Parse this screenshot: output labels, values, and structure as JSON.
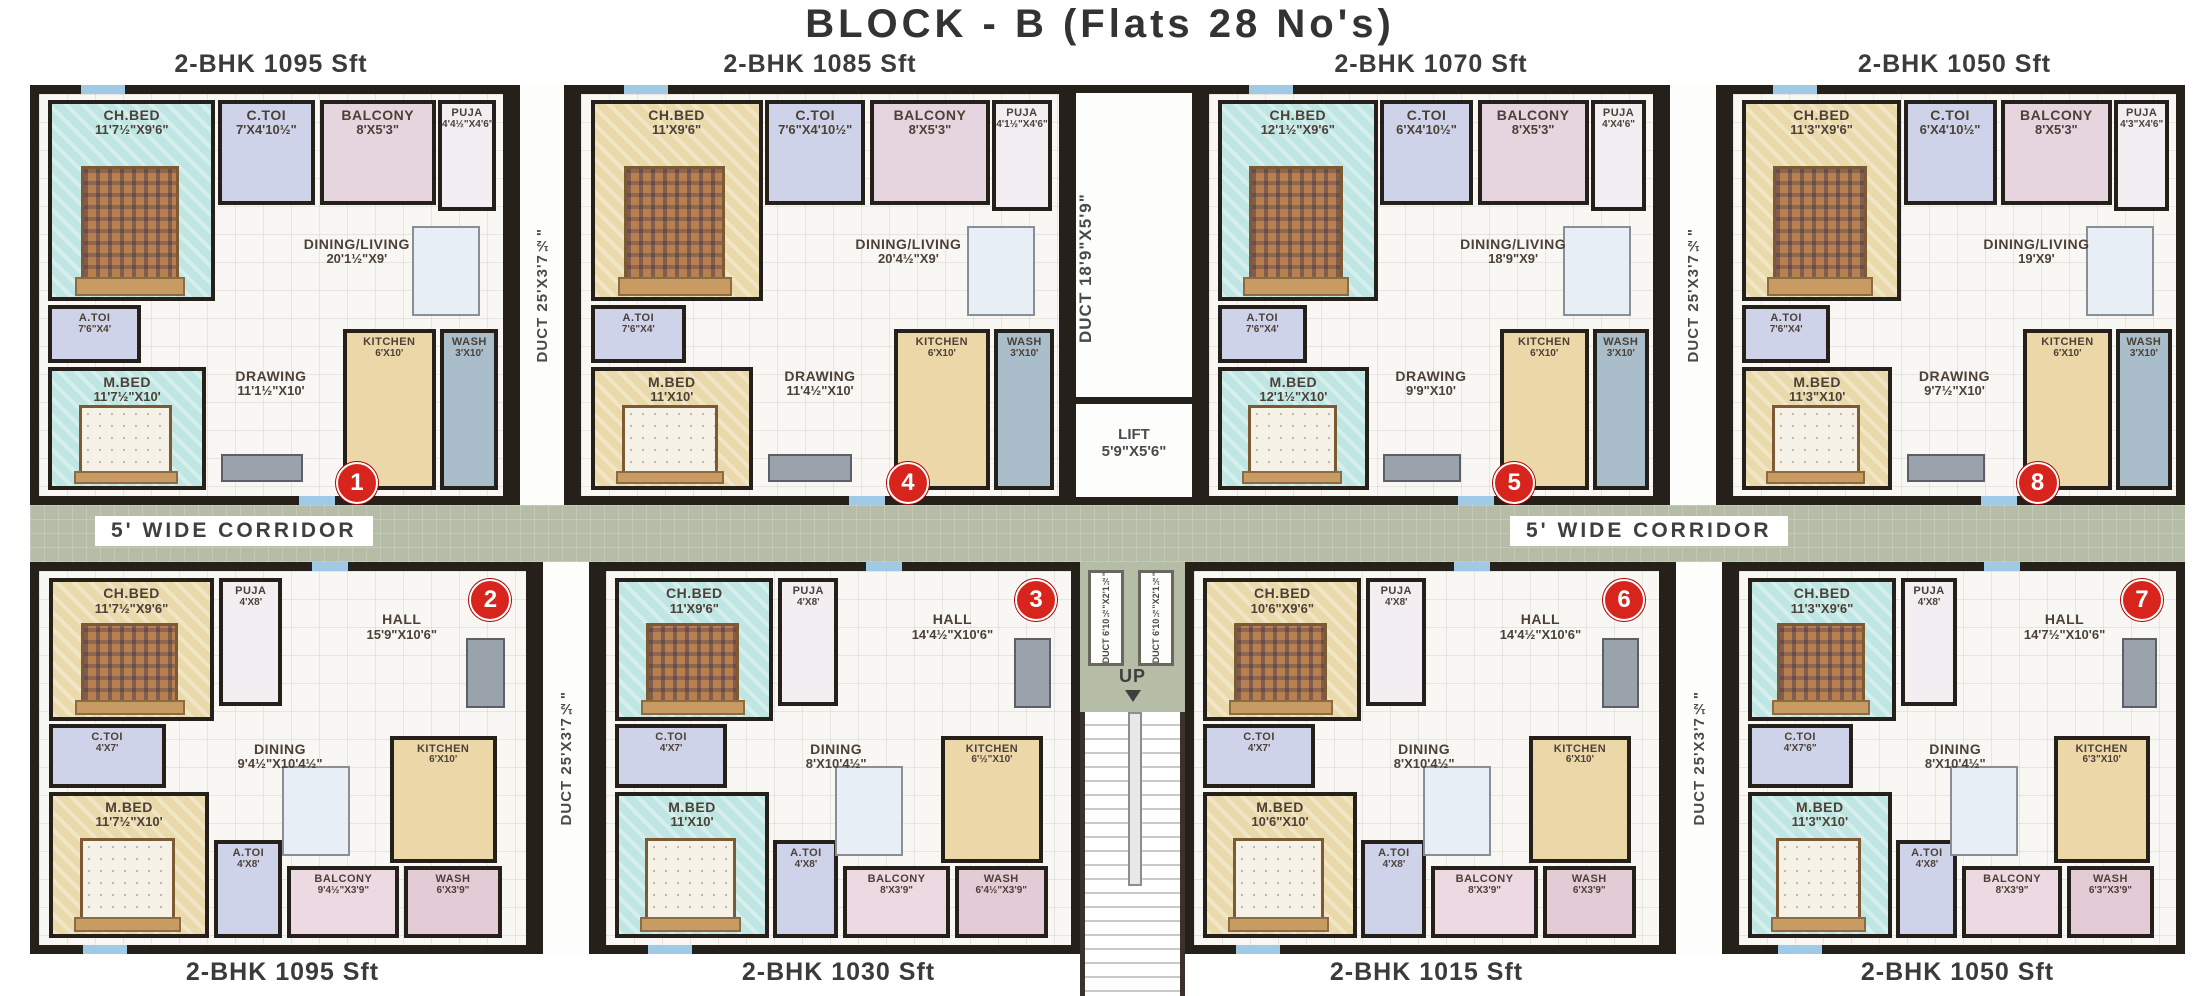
{
  "title": "BLOCK - B (Flats 28 No's)",
  "corridor_label": "5' WIDE CORRIDOR",
  "stairs": {
    "up_label": "UP"
  },
  "lift": {
    "name": "LIFT",
    "dim": "5'9\"X5'6\""
  },
  "ducts": {
    "side": {
      "name": "DUCT",
      "dim": "25'X3'7½\""
    },
    "center": {
      "name": "DUCT",
      "dim": "18'9\"X5'9\""
    },
    "small": {
      "name": "DUCT",
      "dim": "6'10½\"X2'1½\""
    }
  },
  "flats": [
    {
      "id": 1,
      "type_label": "2-BHK 1095 Sft",
      "badge": "1",
      "rooms": {
        "ch_bed": {
          "name": "CH.BED",
          "dim": "11'7½\"X9'6\""
        },
        "c_toi": {
          "name": "C.TOI",
          "dim": "7'X4'10½\""
        },
        "balcony": {
          "name": "BALCONY",
          "dim": "8'X5'3\""
        },
        "puja": {
          "name": "PUJA",
          "dim": "4'4½\"X4'6\""
        },
        "dining": {
          "name": "DINING/LIVING",
          "dim": "20'1½\"X9'"
        },
        "a_toi": {
          "name": "A.TOI",
          "dim": "7'6\"X4'"
        },
        "m_bed": {
          "name": "M.BED",
          "dim": "11'7½\"X10'"
        },
        "drawing": {
          "name": "DRAWING",
          "dim": "11'1½\"X10'"
        },
        "kitchen": {
          "name": "KITCHEN",
          "dim": "6'X10'"
        },
        "wash": {
          "name": "WASH",
          "dim": "3'X10'"
        }
      }
    },
    {
      "id": 4,
      "type_label": "2-BHK 1085 Sft",
      "badge": "4",
      "rooms": {
        "ch_bed": {
          "name": "CH.BED",
          "dim": "11'X9'6\""
        },
        "c_toi": {
          "name": "C.TOI",
          "dim": "7'6\"X4'10½\""
        },
        "balcony": {
          "name": "BALCONY",
          "dim": "8'X5'3\""
        },
        "puja": {
          "name": "PUJA",
          "dim": "4'1½\"X4'6\""
        },
        "dining": {
          "name": "DINING/LIVING",
          "dim": "20'4½\"X9'"
        },
        "a_toi": {
          "name": "A.TOI",
          "dim": "7'6\"X4'"
        },
        "m_bed": {
          "name": "M.BED",
          "dim": "11'X10'"
        },
        "drawing": {
          "name": "DRAWING",
          "dim": "11'4½\"X10'"
        },
        "kitchen": {
          "name": "KITCHEN",
          "dim": "6'X10'"
        },
        "wash": {
          "name": "WASH",
          "dim": "3'X10'"
        }
      }
    },
    {
      "id": 5,
      "type_label": "2-BHK 1070 Sft",
      "badge": "5",
      "rooms": {
        "ch_bed": {
          "name": "CH.BED",
          "dim": "12'1½\"X9'6\""
        },
        "c_toi": {
          "name": "C.TOI",
          "dim": "6'X4'10½\""
        },
        "balcony": {
          "name": "BALCONY",
          "dim": "8'X5'3\""
        },
        "puja": {
          "name": "PUJA",
          "dim": "4'X4'6\""
        },
        "dining": {
          "name": "DINING/LIVING",
          "dim": "18'9\"X9'"
        },
        "a_toi": {
          "name": "A.TOI",
          "dim": "7'6\"X4'"
        },
        "m_bed": {
          "name": "M.BED",
          "dim": "12'1½\"X10'"
        },
        "drawing": {
          "name": "DRAWING",
          "dim": "9'9\"X10'"
        },
        "kitchen": {
          "name": "KITCHEN",
          "dim": "6'X10'"
        },
        "wash": {
          "name": "WASH",
          "dim": "3'X10'"
        }
      }
    },
    {
      "id": 8,
      "type_label": "2-BHK 1050 Sft",
      "badge": "8",
      "rooms": {
        "ch_bed": {
          "name": "CH.BED",
          "dim": "11'3\"X9'6\""
        },
        "c_toi": {
          "name": "C.TOI",
          "dim": "6'X4'10½\""
        },
        "balcony": {
          "name": "BALCONY",
          "dim": "8'X5'3\""
        },
        "puja": {
          "name": "PUJA",
          "dim": "4'3\"X4'6\""
        },
        "dining": {
          "name": "DINING/LIVING",
          "dim": "19'X9'"
        },
        "a_toi": {
          "name": "A.TOI",
          "dim": "7'6\"X4'"
        },
        "m_bed": {
          "name": "M.BED",
          "dim": "11'3\"X10'"
        },
        "drawing": {
          "name": "DRAWING",
          "dim": "9'7½\"X10'"
        },
        "kitchen": {
          "name": "KITCHEN",
          "dim": "6'X10'"
        },
        "wash": {
          "name": "WASH",
          "dim": "3'X10'"
        }
      }
    },
    {
      "id": 2,
      "type_label": "2-BHK 1095 Sft",
      "badge": "2",
      "rooms": {
        "ch_bed": {
          "name": "CH.BED",
          "dim": "11'7½\"X9'6\""
        },
        "puja": {
          "name": "PUJA",
          "dim": "4'X8'"
        },
        "hall": {
          "name": "HALL",
          "dim": "15'9\"X10'6\""
        },
        "c_toi": {
          "name": "C.TOI",
          "dim": "4'X7'"
        },
        "dining": {
          "name": "DINING",
          "dim": "9'4½\"X10'4½\""
        },
        "kitchen": {
          "name": "KITCHEN",
          "dim": "6'X10'"
        },
        "m_bed": {
          "name": "M.BED",
          "dim": "11'7½\"X10'"
        },
        "a_toi": {
          "name": "A.TOI",
          "dim": "4'X8'"
        },
        "balcony": {
          "name": "BALCONY",
          "dim": "9'4½\"X3'9\""
        },
        "wash": {
          "name": "WASH",
          "dim": "6'X3'9\""
        }
      }
    },
    {
      "id": 3,
      "type_label": "2-BHK 1030 Sft",
      "badge": "3",
      "rooms": {
        "ch_bed": {
          "name": "CH.BED",
          "dim": "11'X9'6\""
        },
        "puja": {
          "name": "PUJA",
          "dim": "4'X8'"
        },
        "hall": {
          "name": "HALL",
          "dim": "14'4½\"X10'6\""
        },
        "c_toi": {
          "name": "C.TOI",
          "dim": "4'X7'"
        },
        "dining": {
          "name": "DINING",
          "dim": "8'X10'4½\""
        },
        "kitchen": {
          "name": "KITCHEN",
          "dim": "6'½\"X10'"
        },
        "m_bed": {
          "name": "M.BED",
          "dim": "11'X10'"
        },
        "a_toi": {
          "name": "A.TOI",
          "dim": "4'X8'"
        },
        "balcony": {
          "name": "BALCONY",
          "dim": "8'X3'9\""
        },
        "wash": {
          "name": "WASH",
          "dim": "6'4½\"X3'9\""
        }
      }
    },
    {
      "id": 6,
      "type_label": "2-BHK 1015 Sft",
      "badge": "6",
      "rooms": {
        "ch_bed": {
          "name": "CH.BED",
          "dim": "10'6\"X9'6\""
        },
        "puja": {
          "name": "PUJA",
          "dim": "4'X8'"
        },
        "hall": {
          "name": "HALL",
          "dim": "14'4½\"X10'6\""
        },
        "c_toi": {
          "name": "C.TOI",
          "dim": "4'X7'"
        },
        "dining": {
          "name": "DINING",
          "dim": "8'X10'4½\""
        },
        "kitchen": {
          "name": "KITCHEN",
          "dim": "6'X10'"
        },
        "m_bed": {
          "name": "M.BED",
          "dim": "10'6\"X10'"
        },
        "a_toi": {
          "name": "A.TOI",
          "dim": "4'X8'"
        },
        "balcony": {
          "name": "BALCONY",
          "dim": "8'X3'9\""
        },
        "wash": {
          "name": "WASH",
          "dim": "6'X3'9\""
        }
      }
    },
    {
      "id": 7,
      "type_label": "2-BHK 1050 Sft",
      "badge": "7",
      "rooms": {
        "ch_bed": {
          "name": "CH.BED",
          "dim": "11'3\"X9'6\""
        },
        "puja": {
          "name": "PUJA",
          "dim": "4'X8'"
        },
        "hall": {
          "name": "HALL",
          "dim": "14'7½\"X10'6\""
        },
        "c_toi": {
          "name": "C.TOI",
          "dim": "4'X7'6\""
        },
        "dining": {
          "name": "DINING",
          "dim": "8'X10'4½\""
        },
        "kitchen": {
          "name": "KITCHEN",
          "dim": "6'3\"X10'"
        },
        "m_bed": {
          "name": "M.BED",
          "dim": "11'3\"X10'"
        },
        "a_toi": {
          "name": "A.TOI",
          "dim": "4'X8'"
        },
        "balcony": {
          "name": "BALCONY",
          "dim": "8'X3'9\""
        },
        "wash": {
          "name": "WASH",
          "dim": "6'3\"X3'9\""
        }
      }
    }
  ]
}
